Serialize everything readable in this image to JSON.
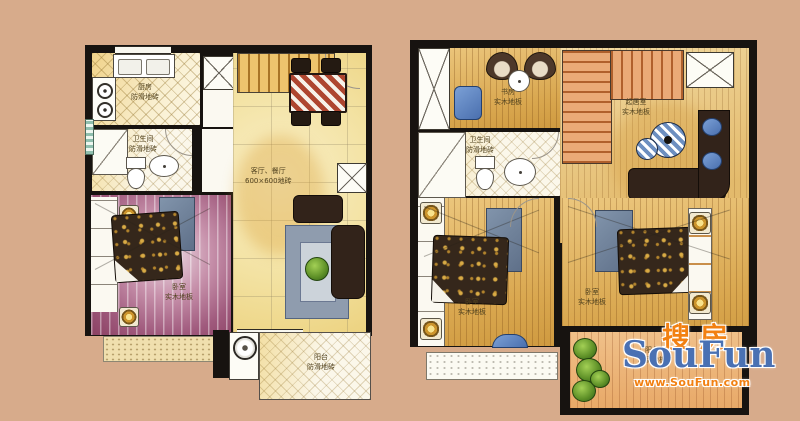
{
  "image": {
    "background_color": "#d7ab8b",
    "wall_color": "#171310",
    "description_colors": {
      "kitchen_tile": "#f0d289",
      "living_tile": "#f3e2a2",
      "bedroom_wash": "#a05a7d",
      "wood_floor": "#d9a74f",
      "stair_red": "#b0602c"
    }
  },
  "watermark": {
    "cn": "搜房",
    "en": "SouFun",
    "url": "www.SouFun.com",
    "orange": "#f28011",
    "blue": "#4a71b3"
  },
  "floor1": {
    "kitchen": {
      "name": "厨房",
      "floor": "防滑地砖"
    },
    "bath": {
      "name": "卫生间",
      "floor": "防滑地砖"
    },
    "living": {
      "name": "客厅、餐厅",
      "floor": "600×600地砖"
    },
    "bedroom": {
      "name": "卧室",
      "floor": "实木地板"
    },
    "balcony": {
      "name": "阳台",
      "floor": "防滑地砖"
    }
  },
  "floor2": {
    "study": {
      "name": "书房",
      "floor": "实木地板"
    },
    "bath": {
      "name": "卫生间",
      "floor": "防滑地砖"
    },
    "lounge": {
      "name": "起居室",
      "floor": "实木地板"
    },
    "bedroom_left": {
      "name": "卧室",
      "floor": "实木地板"
    },
    "bedroom_right": {
      "name": "卧室",
      "floor": "实木地板"
    },
    "balcony": {
      "name": "阳台",
      "floor": "防腐地板"
    }
  }
}
